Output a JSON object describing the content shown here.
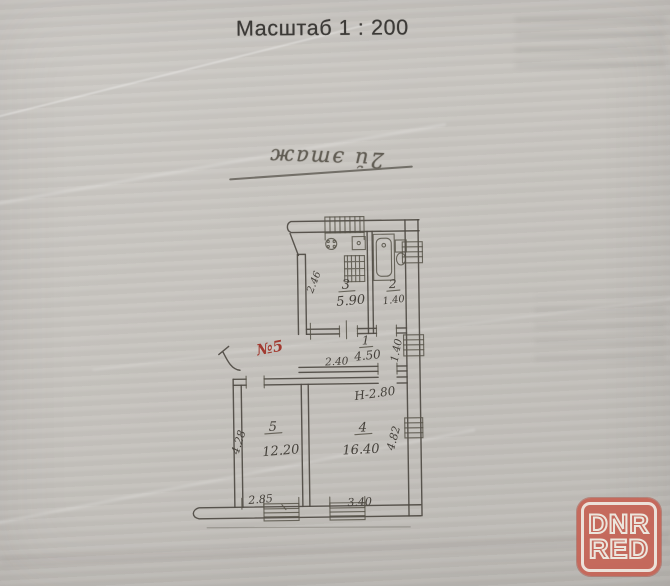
{
  "page": {
    "scale_title": "Масштаб 1 : 200",
    "handwritten_note": "2й этаж"
  },
  "floor_plan": {
    "red_mark": "№5",
    "height_note": "Н-2.80",
    "rooms": [
      {
        "id": "kitchen",
        "number": "3",
        "area": "5.90"
      },
      {
        "id": "bathroom",
        "number": "2",
        "area": "1.40"
      },
      {
        "id": "hall",
        "number": "1",
        "area": "4.50"
      },
      {
        "id": "room-5",
        "number": "5",
        "area": "12.20"
      },
      {
        "id": "room-4",
        "number": "4",
        "area": "16.40"
      }
    ],
    "dimensions": {
      "hall_width": "2.40",
      "bath_side": "1.40",
      "kitchen_side": "2.46",
      "room5_side": "4.28",
      "room4_side": "4.82",
      "room5_width": "2.85",
      "room4_width": "3.40"
    },
    "symbols": [
      "window-symbol",
      "stove-icon",
      "sink-icon",
      "bathtub-icon",
      "toilet-icon",
      "balcony-railing"
    ]
  },
  "watermark": {
    "line1": "DNR",
    "line2": "RED",
    "accent_color": "#c5635с",
    "text_color": "#ece6dd"
  }
}
